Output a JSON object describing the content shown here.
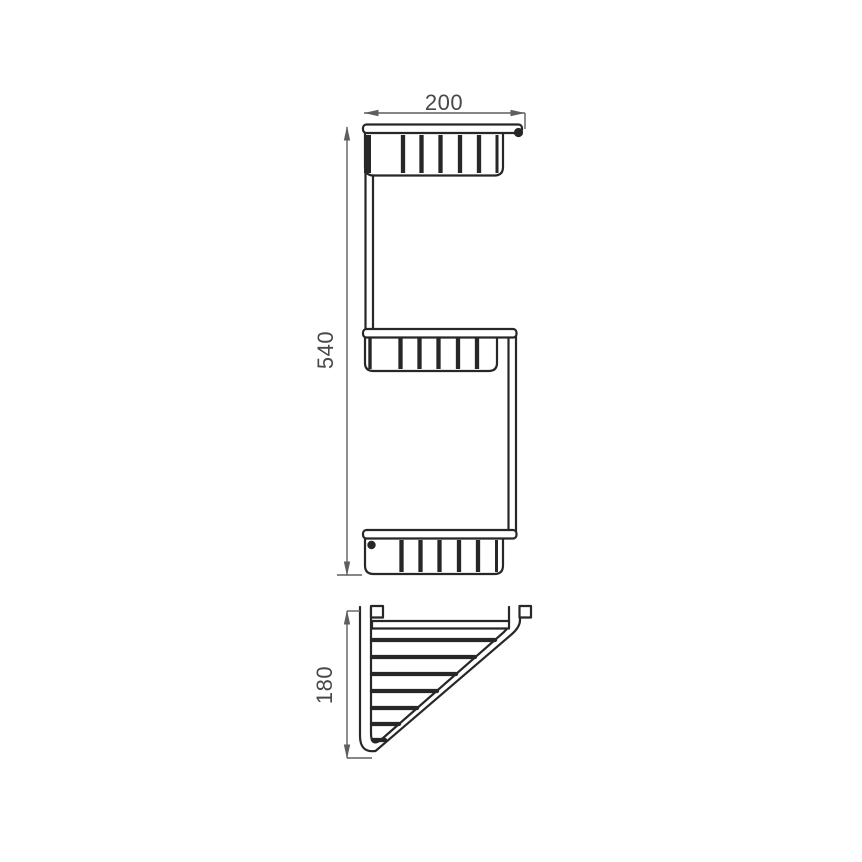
{
  "drawing": {
    "background_color": "#ffffff",
    "line_color": "#272727",
    "dimension_line_color": "#5e5e5e",
    "text_color": "#484848",
    "views": {
      "front_elevation": {
        "width_dimension": "200",
        "height_dimension": "540",
        "tier_count": 3
      },
      "top_plan": {
        "depth_dimension": "180",
        "wire_bar_count": 7
      }
    }
  }
}
